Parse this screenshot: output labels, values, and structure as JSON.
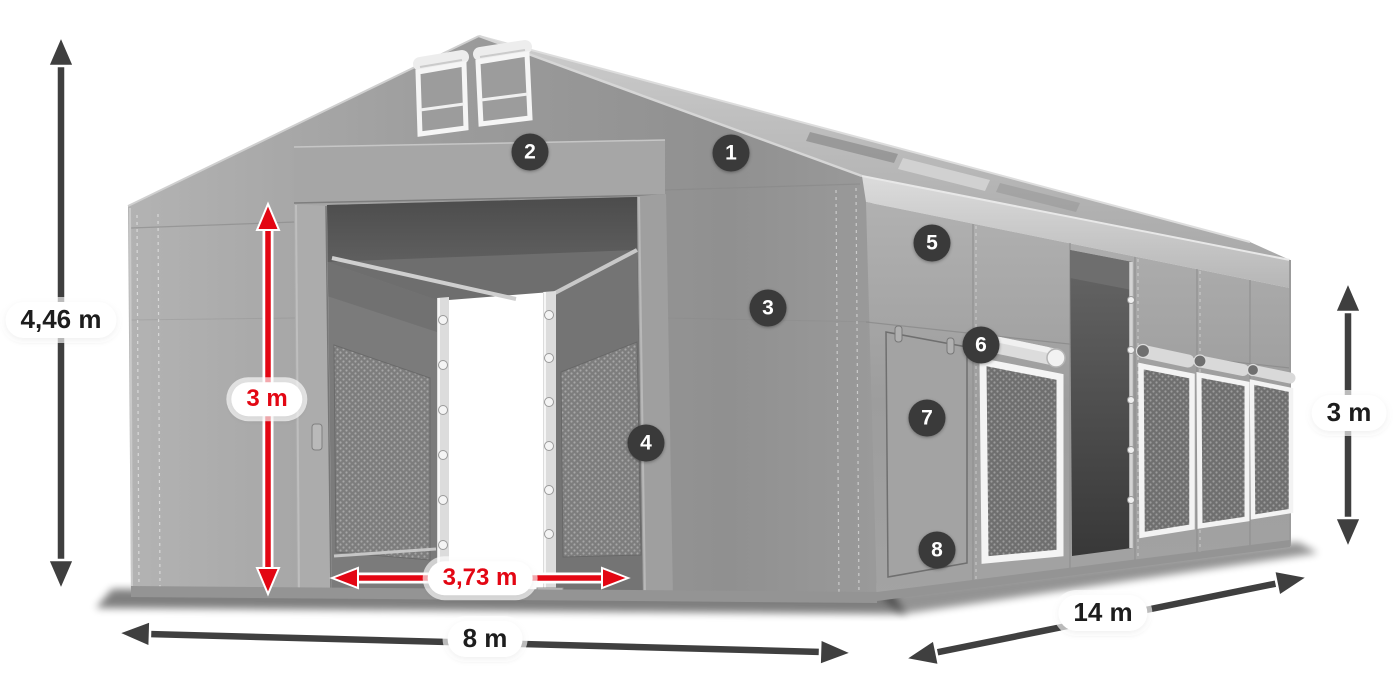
{
  "figure": {
    "description": "3D product diagram of a grey PVC storage tent with numbered feature callouts and dimension arrows",
    "background": "#ffffff"
  },
  "dimensions": {
    "total_height": "4,46 m",
    "entrance_height": "3 m",
    "entrance_width": "3,73 m",
    "front_width": "8 m",
    "side_length": "14 m",
    "side_wall_height": "3 m"
  },
  "callouts": [
    {
      "number": "1"
    },
    {
      "number": "2"
    },
    {
      "number": "3"
    },
    {
      "number": "4"
    },
    {
      "number": "5"
    },
    {
      "number": "6"
    },
    {
      "number": "7"
    },
    {
      "number": "8"
    }
  ],
  "colors": {
    "accent_red": "#e30613",
    "arrow_dark": "#3f3f3f",
    "badge_background": "#3a3a3a",
    "badge_text": "#ffffff",
    "label_text": "#1d1d1d",
    "label_pill": "#ffffff",
    "tent_grey": "#9e9e9e"
  }
}
